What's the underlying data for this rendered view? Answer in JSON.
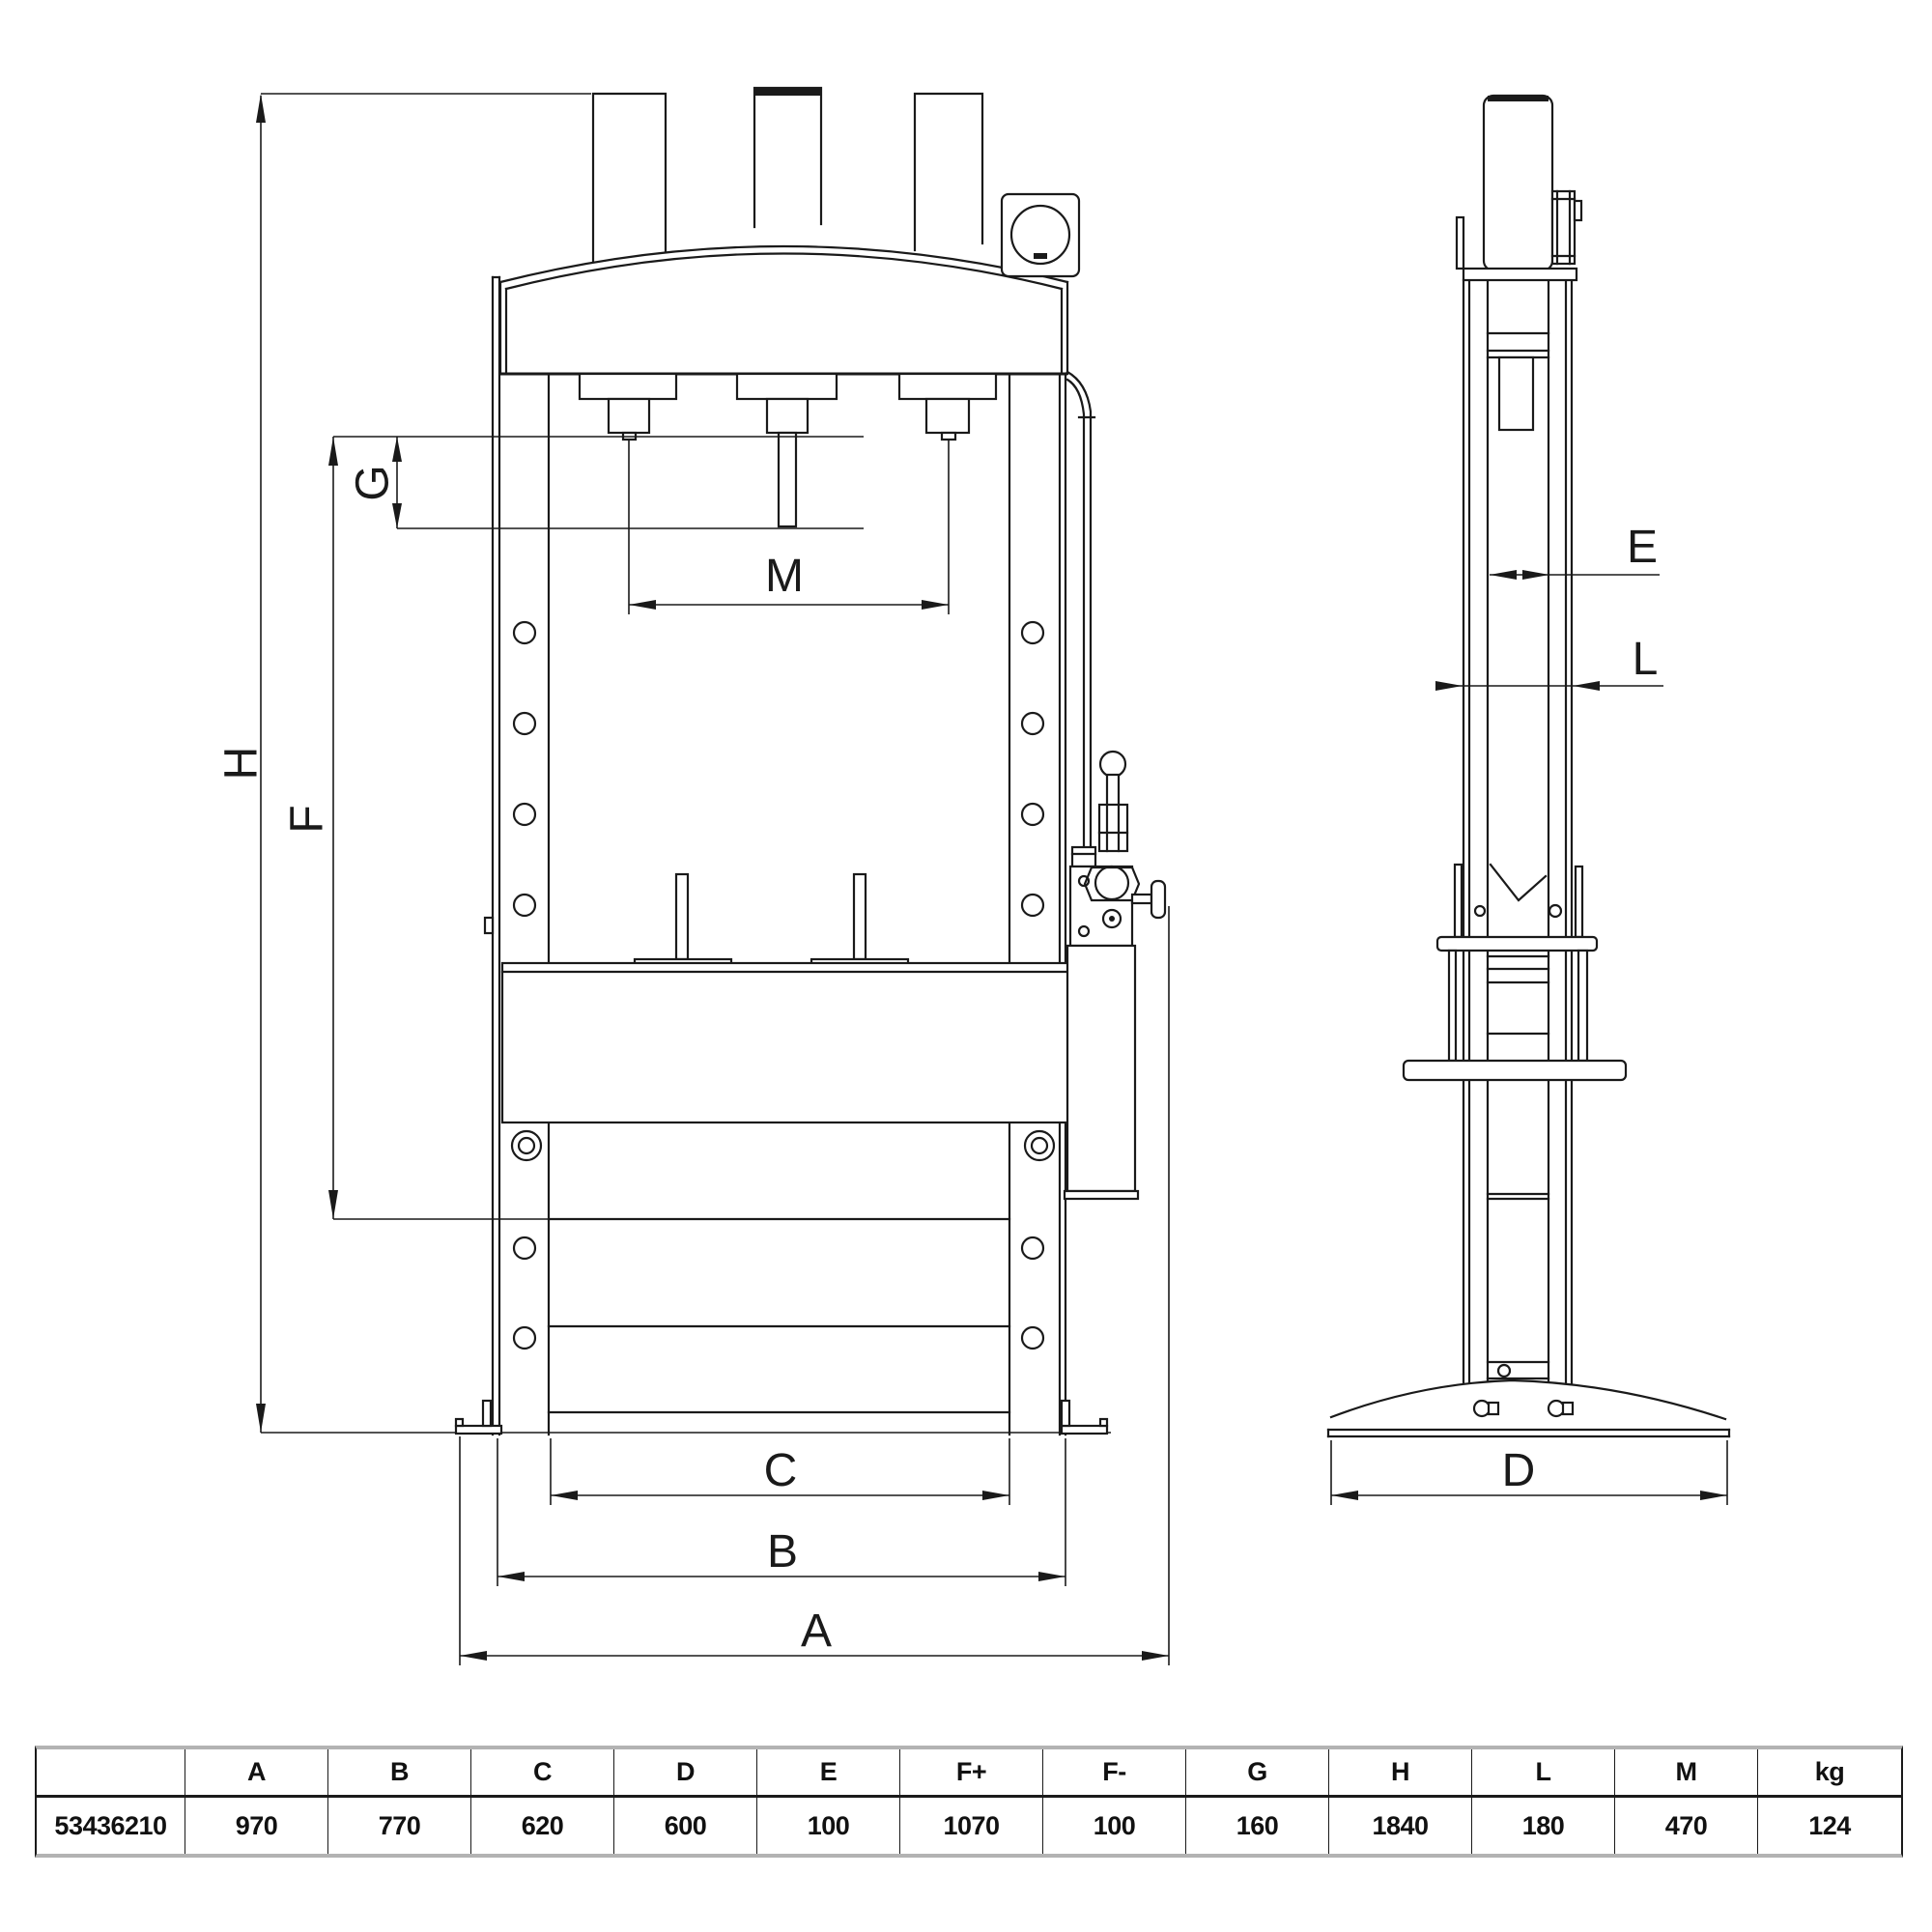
{
  "labels": {
    "H": "H",
    "F": "F",
    "G": "G",
    "M": "M",
    "C": "C",
    "B": "B",
    "A": "A",
    "E": "E",
    "L": "L",
    "D": "D"
  },
  "table": {
    "headers": [
      "",
      "A",
      "B",
      "C",
      "D",
      "E",
      "F+",
      "F-",
      "G",
      "H",
      "L",
      "M",
      "kg"
    ],
    "row": {
      "code": "53436210",
      "values": [
        "970",
        "770",
        "620",
        "600",
        "100",
        "1070",
        "100",
        "160",
        "1840",
        "180",
        "470",
        "124"
      ]
    }
  },
  "colors": {
    "line": "#1a1a1a",
    "table_border_gray": "#b3b3b3",
    "background": "#ffffff"
  }
}
